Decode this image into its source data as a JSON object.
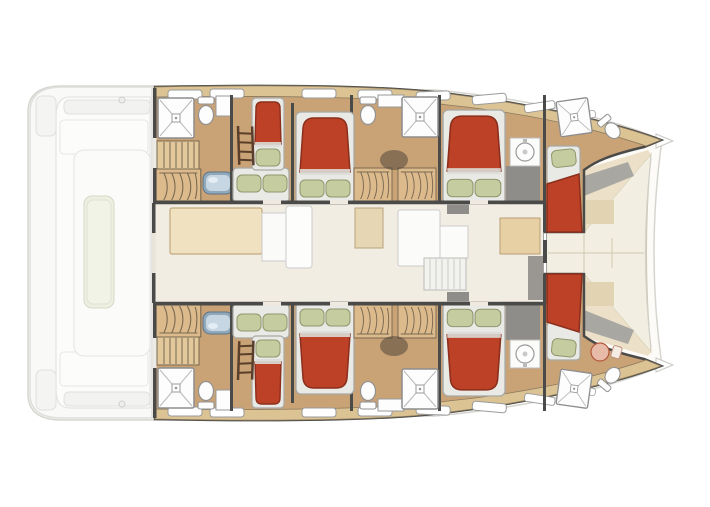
{
  "meta": {
    "title": "Catamaran yacht deck plan — twin-hull 8-cabin layout, bows to the right, aft cockpit to the left"
  },
  "colors": {
    "canvas": "#ffffff",
    "silhouette": "#fcfbf7",
    "outline-light": "#d7d5cf",
    "wall": "#4a4a48",
    "hull-floor": "#c9a276",
    "deck-wood": "#dcc394",
    "deck-wood-edge": "#8a7a5d",
    "wood-trim": "#e7d0a4",
    "wood-trim-edge": "#b99f74",
    "bed-red": "#bc4127",
    "bed-red-dark": "#8c2f1c",
    "mattress": "#e9e9e6",
    "mattress-edge": "#a9a9a5",
    "pillow": "#c5cda0",
    "pillow-edge": "#8e976d",
    "salon-floor": "#f2ede3",
    "foredeck": "#f2efe2",
    "seam": "#cfc8b0",
    "fixture-white": "#fdfdfd",
    "fixture-stroke": "#929292",
    "sink-steel": "#8fa8ba",
    "sink-steel-light": "#c6d6e2",
    "gray-step": "#8f8d89",
    "exterior-deck": "#f9f9f8",
    "exterior-line": "#dededc",
    "cockpit-table": "#edefe1",
    "locker-wood": "#dcba8c",
    "locker-line": "#7a6a52",
    "shadow": "#3a342c"
  },
  "plan": {
    "hulls": [
      {
        "name": "port hull (top)",
        "cabins": [
          {
            "name": "aft cabin",
            "beds": [
              "double berth",
              "single berth"
            ],
            "features": [
              "ladder",
              "companionway stairs",
              "hanging lockers",
              "washbasin",
              "shower",
              "toilet"
            ]
          },
          {
            "name": "midship cabin",
            "beds": [
              "double berth"
            ],
            "features": [
              "ensuite shower",
              "toilet",
              "wardrobes"
            ]
          },
          {
            "name": "forward cabin",
            "beds": [
              "double berth"
            ],
            "features": [
              "vanity washbasin"
            ]
          },
          {
            "name": "forepeak cabin",
            "beds": [
              "single berth"
            ],
            "features": [
              "shower",
              "toilet"
            ]
          }
        ]
      },
      {
        "name": "starboard hull (bottom)",
        "cabins": [
          {
            "name": "aft cabin",
            "beds": [
              "double berth",
              "single berth"
            ],
            "features": [
              "ladder",
              "companionway stairs",
              "hanging lockers",
              "washbasin",
              "shower",
              "toilet"
            ]
          },
          {
            "name": "midship cabin",
            "beds": [
              "double berth"
            ],
            "features": [
              "ensuite shower",
              "toilet",
              "wardrobes"
            ]
          },
          {
            "name": "forward cabin",
            "beds": [
              "double berth"
            ],
            "features": [
              "vanity washbasin"
            ]
          },
          {
            "name": "forepeak crew cabin",
            "beds": [
              "single berth"
            ],
            "features": [
              "shower",
              "toilet",
              "washbasin"
            ]
          }
        ]
      }
    ],
    "salon": {
      "name": "bridgedeck salon",
      "features": [
        "dining table",
        "L-shaped sofa",
        "galley counters",
        "companionway stairs",
        "chart table",
        "mast post"
      ]
    },
    "cockpit": {
      "name": "aft cockpit and platforms",
      "features": [
        "cockpit table",
        "bench seating",
        "transom steps",
        "swim platform"
      ]
    },
    "foredeck": {
      "name": "foredeck",
      "features": [
        "lounge panels",
        "twin bows",
        "forward crossbeam"
      ]
    }
  },
  "legend": {
    "bed": "red duvet with sage-green pillows on white mattress",
    "shower": "square stall with X to central drain",
    "toilet": "oval bowl with cistern",
    "wardrobe": "wood locker with hanging-clothes squiggles",
    "stairs": "striped treads"
  }
}
